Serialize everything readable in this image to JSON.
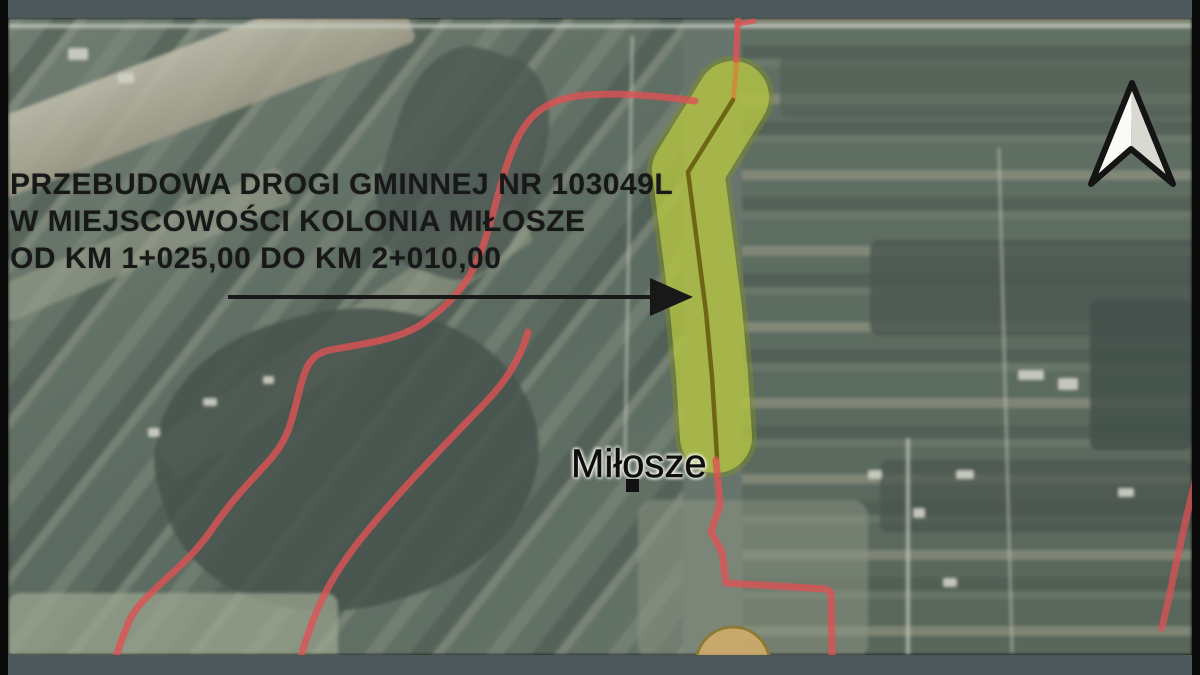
{
  "annotation": {
    "title_lines": [
      "PRZEBUDOWA DROGI GMINNEJ NR 103049L",
      "W MIEJSCOWOŚCI KOLONIA MIŁOSZE",
      "OD KM 1+025,00 DO KM 2+010,00"
    ]
  },
  "map": {
    "place_label": "Miłosze"
  },
  "colors": {
    "boundary_red": "#dd5254",
    "corridor_fill": "#c8d84a",
    "corridor_edge": "#7f8f26",
    "centerline_olive": "#6a5f10",
    "centerline_orange": "#d08a3a",
    "circle_fill": "#dcb269",
    "circle_edge": "#8a7a35",
    "frame_strip": "#4c5759",
    "side_bar": "#0a0a0a",
    "ink": "#181818",
    "north_fill_left": "#fafaf7",
    "north_fill_right": "#d9d9d2"
  }
}
